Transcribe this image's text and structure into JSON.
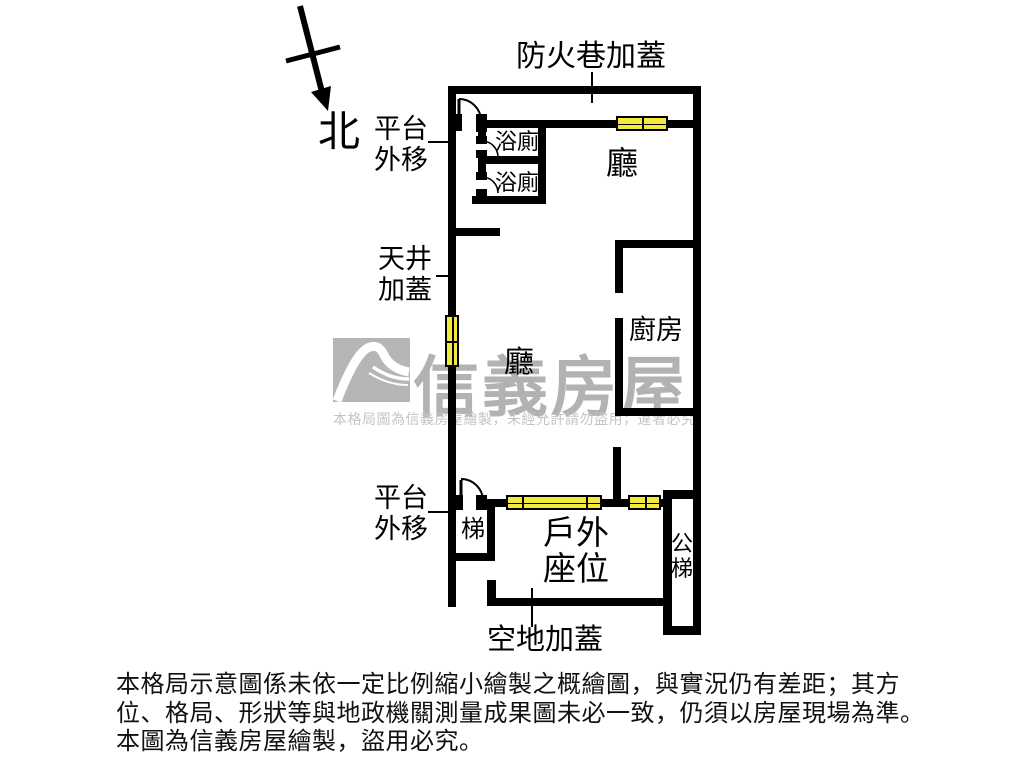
{
  "plan": {
    "north_label": "北",
    "labels": {
      "fire_lane": "防火巷加蓋",
      "platform_top": {
        "line1": "平台",
        "line2": "外移"
      },
      "bath": "浴廁",
      "hall_top": "廳",
      "skylight": {
        "line1": "天井",
        "line2": "加蓋"
      },
      "hall_center": "廳",
      "kitchen": "廚房",
      "platform_bottom": {
        "line1": "平台",
        "line2": "外移"
      },
      "stairs": "梯",
      "outdoor": {
        "line1": "戶外",
        "line2": "座位"
      },
      "public_stairs": {
        "char1": "公",
        "char2": "梯"
      },
      "open_land": "空地加蓋"
    }
  },
  "watermark": {
    "brand": "信義房屋",
    "notice": "本格局圖為信義房屋繪製，未經允許請勿盜用，違者必究"
  },
  "disclaimer": {
    "line1": "本格局示意圖係未依一定比例縮小繪製之概繪圖，與實況仍有差距；其方",
    "line2": "位、格局、形狀等與地政機關測量成果圖未必一致，仍須以房屋現場為準。",
    "line3": "本圖為信義房屋繪製，盜用必究。"
  },
  "colors": {
    "wall": "#000000",
    "window_fill": "#f2ea3d",
    "watermark_gray": "#b2b2b2",
    "notice_gray": "#c4c4c4"
  }
}
